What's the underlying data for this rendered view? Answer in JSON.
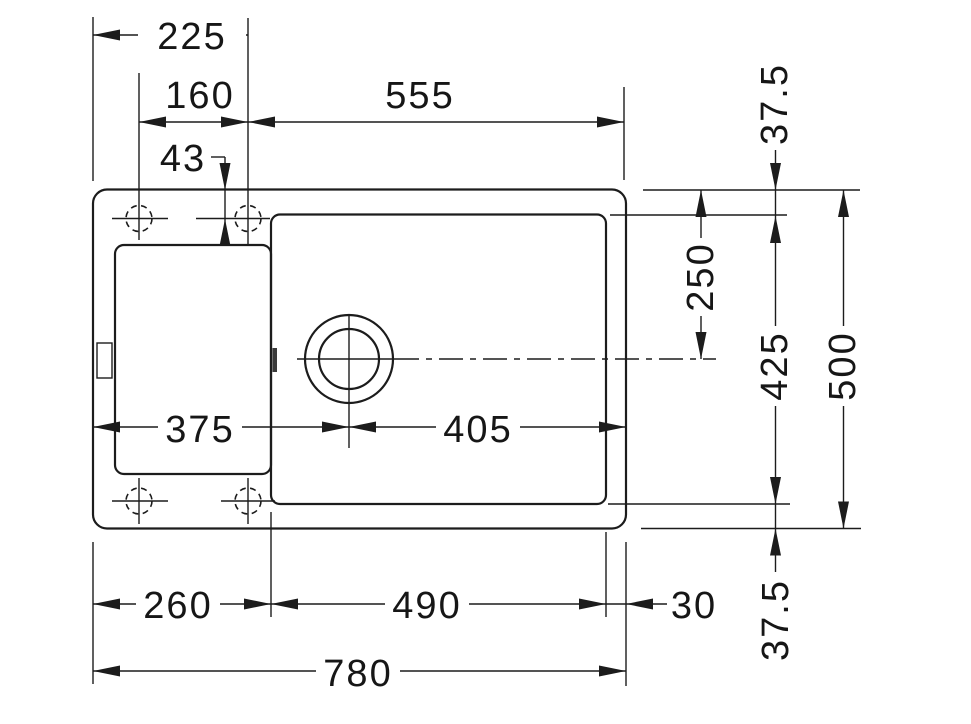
{
  "dimensions": {
    "v225": "225",
    "v160": "160",
    "v555": "555",
    "v43": "43",
    "v375": "375",
    "v405": "405",
    "v260": "260",
    "v490": "490",
    "v30": "30",
    "v780": "780",
    "v250": "250",
    "v425": "425",
    "v500": "500",
    "v37_5_top": "37.5",
    "v37_5_bottom": "37.5"
  }
}
